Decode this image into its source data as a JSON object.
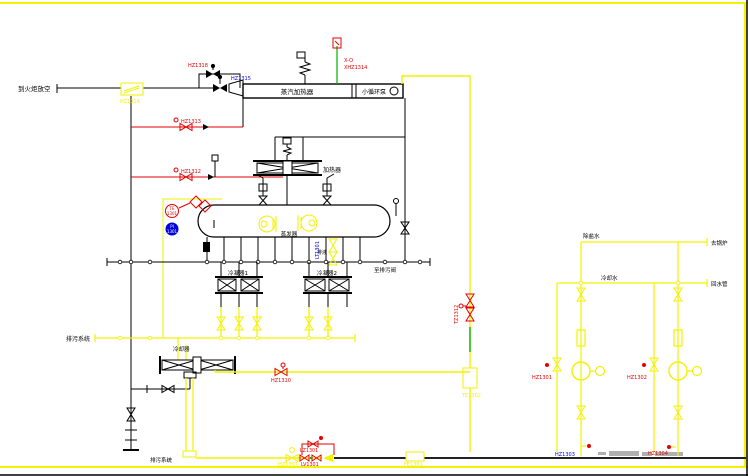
{
  "drawing": {
    "colors": {
      "line_black": "#000000",
      "pipe_yellow": "#f2f200",
      "signal_red": "#e60000",
      "tag_blue": "#0000dd",
      "safety_green": "#00b400",
      "watermark_gray": "#b0b0b0"
    },
    "streams": {
      "flare": "到火炬放空",
      "blowdown_header": "排污系统",
      "drain_right": "至排污阀",
      "blowdown_bottom": "排污系统",
      "demin_water": "除盐水",
      "to_boiler": "去锅炉",
      "cooling_water": "冷却水",
      "return_water": "回水管"
    },
    "equipment": {
      "steam_heater": "蒸汽加热器",
      "circ_pump": "小循环泵",
      "preheater": "加热器",
      "evaporator": "蒸发器",
      "condenser_1": "冷凝器1",
      "condenser_2": "冷凝器2",
      "cooler": "冷却器",
      "drain_note": "排液"
    },
    "tags": {
      "hz1318": "HZ1318",
      "hz1315": "HZ1315",
      "hz1316": "HZ1316",
      "x_o": "X-O",
      "xhz1314": "XHZ1314",
      "hz1313": "HZ1313",
      "hz1312": "HZ1312",
      "te_top": "TE",
      "te_num": "1301",
      "pi_top": "PI",
      "pi_num": "1301",
      "lt1301": "LT1301",
      "hz1310": "HZ1310",
      "tz1312": "TZ1312",
      "te1302": "TE1302",
      "hz1307": "HZ1307",
      "lz1301": "LZ1301",
      "lv1301": "LV1301",
      "fe1301": "FE1301",
      "hz1301": "HZ1301",
      "hz1302": "HZ1302",
      "hz1303": "HZ1303",
      "hz1304": "HZ1304"
    }
  }
}
